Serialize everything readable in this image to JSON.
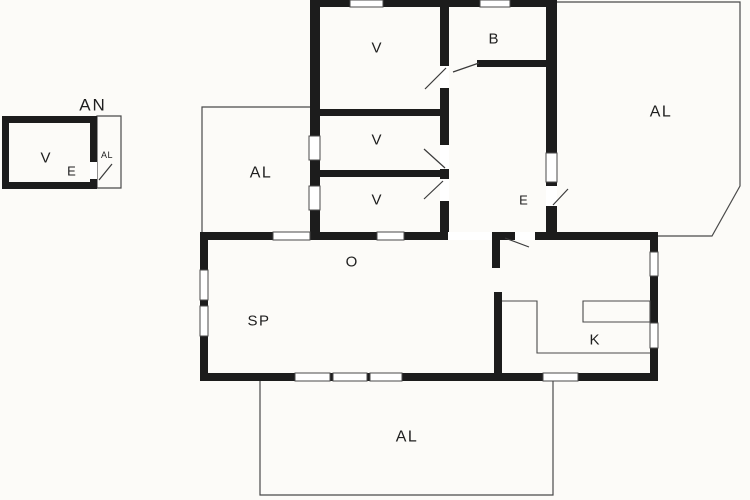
{
  "plan": {
    "title": "floor-plan",
    "background": "#fcfbf8",
    "colors": {
      "wall": "#1c1c1c",
      "thin_line": "#4a4a4a",
      "swing_line": "#3a3a3a",
      "window_fill": "#ffffff",
      "text": "#1e1e1e"
    },
    "labels": [
      {
        "id": "annex-title",
        "text": "AN",
        "x": 93,
        "y": 105,
        "size": 17,
        "ls": 2
      },
      {
        "id": "annex-room-v",
        "text": "V",
        "x": 46,
        "y": 158,
        "size": 15,
        "ls": 1
      },
      {
        "id": "annex-entry-e",
        "text": "E",
        "x": 72,
        "y": 171,
        "size": 13,
        "ls": 1
      },
      {
        "id": "annex-terrace",
        "text": "AL",
        "x": 107,
        "y": 155,
        "size": 9,
        "ls": 0.5
      },
      {
        "id": "bedroom-1",
        "text": "V",
        "x": 377,
        "y": 48,
        "size": 15,
        "ls": 1
      },
      {
        "id": "bathroom",
        "text": "B",
        "x": 494,
        "y": 39,
        "size": 15,
        "ls": 1
      },
      {
        "id": "terrace-ne",
        "text": "AL",
        "x": 661,
        "y": 112,
        "size": 16,
        "ls": 1.5
      },
      {
        "id": "bedroom-2",
        "text": "V",
        "x": 377,
        "y": 140,
        "size": 15,
        "ls": 1
      },
      {
        "id": "bedroom-3",
        "text": "V",
        "x": 377,
        "y": 200,
        "size": 15,
        "ls": 1
      },
      {
        "id": "terrace-west",
        "text": "AL",
        "x": 261,
        "y": 173,
        "size": 16,
        "ls": 1.5
      },
      {
        "id": "entrance",
        "text": "E",
        "x": 524,
        "y": 200,
        "size": 13,
        "ls": 1
      },
      {
        "id": "living-room-o",
        "text": "O",
        "x": 352,
        "y": 262,
        "size": 15,
        "ls": 1
      },
      {
        "id": "dining-sp",
        "text": "SP",
        "x": 259,
        "y": 321,
        "size": 15,
        "ls": 1.5
      },
      {
        "id": "kitchen",
        "text": "K",
        "x": 595,
        "y": 340,
        "size": 15,
        "ls": 1
      },
      {
        "id": "terrace-south",
        "text": "AL",
        "x": 407,
        "y": 437,
        "size": 16,
        "ls": 1.5
      }
    ],
    "walls": [
      {
        "x": 310,
        "y": 0,
        "w": 247,
        "h": 7
      },
      {
        "x": 310,
        "y": 0,
        "w": 10,
        "h": 240
      },
      {
        "x": 440,
        "y": 0,
        "w": 9,
        "h": 240
      },
      {
        "x": 546,
        "y": 0,
        "w": 11,
        "h": 240
      },
      {
        "x": 310,
        "y": 109,
        "w": 139,
        "h": 7
      },
      {
        "x": 310,
        "y": 170,
        "w": 139,
        "h": 7
      },
      {
        "x": 477,
        "y": 60,
        "w": 80,
        "h": 7
      },
      {
        "x": 200,
        "y": 232,
        "w": 458,
        "h": 8
      },
      {
        "x": 200,
        "y": 232,
        "w": 8,
        "h": 149
      },
      {
        "x": 200,
        "y": 373,
        "w": 458,
        "h": 8
      },
      {
        "x": 650,
        "y": 232,
        "w": 8,
        "h": 149
      },
      {
        "x": 492,
        "y": 235,
        "w": 8,
        "h": 33
      },
      {
        "x": 494,
        "y": 292,
        "w": 8,
        "h": 85
      },
      {
        "x": 2,
        "y": 116,
        "w": 95,
        "h": 7
      },
      {
        "x": 2,
        "y": 182,
        "w": 95,
        "h": 7
      },
      {
        "x": 2,
        "y": 116,
        "w": 7,
        "h": 73
      },
      {
        "x": 90,
        "y": 116,
        "w": 7,
        "h": 73
      }
    ],
    "windows": [
      {
        "x": 350,
        "y": 0,
        "w": 33,
        "h": 7
      },
      {
        "x": 480,
        "y": 0,
        "w": 30,
        "h": 7
      },
      {
        "x": 309,
        "y": 136,
        "w": 11,
        "h": 24
      },
      {
        "x": 309,
        "y": 186,
        "w": 11,
        "h": 24
      },
      {
        "x": 546,
        "y": 153,
        "w": 11,
        "h": 29
      },
      {
        "x": 273,
        "y": 232,
        "w": 37,
        "h": 8
      },
      {
        "x": 377,
        "y": 232,
        "w": 27,
        "h": 8
      },
      {
        "x": 200,
        "y": 270,
        "w": 8,
        "h": 30
      },
      {
        "x": 200,
        "y": 306,
        "w": 8,
        "h": 30
      },
      {
        "x": 295,
        "y": 373,
        "w": 35,
        "h": 8
      },
      {
        "x": 333,
        "y": 373,
        "w": 34,
        "h": 8
      },
      {
        "x": 370,
        "y": 373,
        "w": 32,
        "h": 8
      },
      {
        "x": 543,
        "y": 373,
        "w": 35,
        "h": 8
      },
      {
        "x": 650,
        "y": 252,
        "w": 8,
        "h": 24
      },
      {
        "x": 650,
        "y": 323,
        "w": 8,
        "h": 25
      }
    ],
    "door_gaps": [
      {
        "x": 440,
        "y": 66,
        "w": 9,
        "h": 22
      },
      {
        "x": 440,
        "y": 145,
        "w": 9,
        "h": 24
      },
      {
        "x": 440,
        "y": 179,
        "w": 9,
        "h": 22
      },
      {
        "x": 546,
        "y": 186,
        "w": 11,
        "h": 20
      },
      {
        "x": 448,
        "y": 232,
        "w": 44,
        "h": 8
      },
      {
        "x": 515,
        "y": 232,
        "w": 20,
        "h": 8
      },
      {
        "x": 90,
        "y": 162,
        "w": 7,
        "h": 17
      }
    ],
    "door_swings": [
      {
        "x1": 446,
        "y1": 68,
        "x2": 425,
        "y2": 89
      },
      {
        "x1": 453,
        "y1": 72,
        "x2": 479,
        "y2": 63
      },
      {
        "x1": 445,
        "y1": 168,
        "x2": 424,
        "y2": 149
      },
      {
        "x1": 443,
        "y1": 181,
        "x2": 424,
        "y2": 199
      },
      {
        "x1": 553,
        "y1": 205,
        "x2": 568,
        "y2": 189
      },
      {
        "x1": 505,
        "y1": 238,
        "x2": 529,
        "y2": 247
      },
      {
        "x1": 99,
        "y1": 180,
        "x2": 112,
        "y2": 164
      }
    ],
    "terrace_outlines": [
      {
        "id": "terrace-ne",
        "path": "M557,2 L740,2 L740,186 L712,236 L658,236"
      },
      {
        "id": "terrace-west",
        "path": "M202,236 L202,107 L313,107"
      },
      {
        "id": "terrace-south",
        "path": "M260,381 L260,495 L553,495 L553,381"
      },
      {
        "id": "annex-terrace",
        "path": "M97,116 L121,116 L121,188 L97,188 Z"
      }
    ],
    "counter_outlines": [
      {
        "id": "kitchen-counter",
        "path": "M502,301 L537,301 L537,353 L650,353"
      },
      {
        "id": "kitchen-island",
        "path": "M583,301 L650,301 L650,322 L583,322 Z"
      }
    ]
  }
}
